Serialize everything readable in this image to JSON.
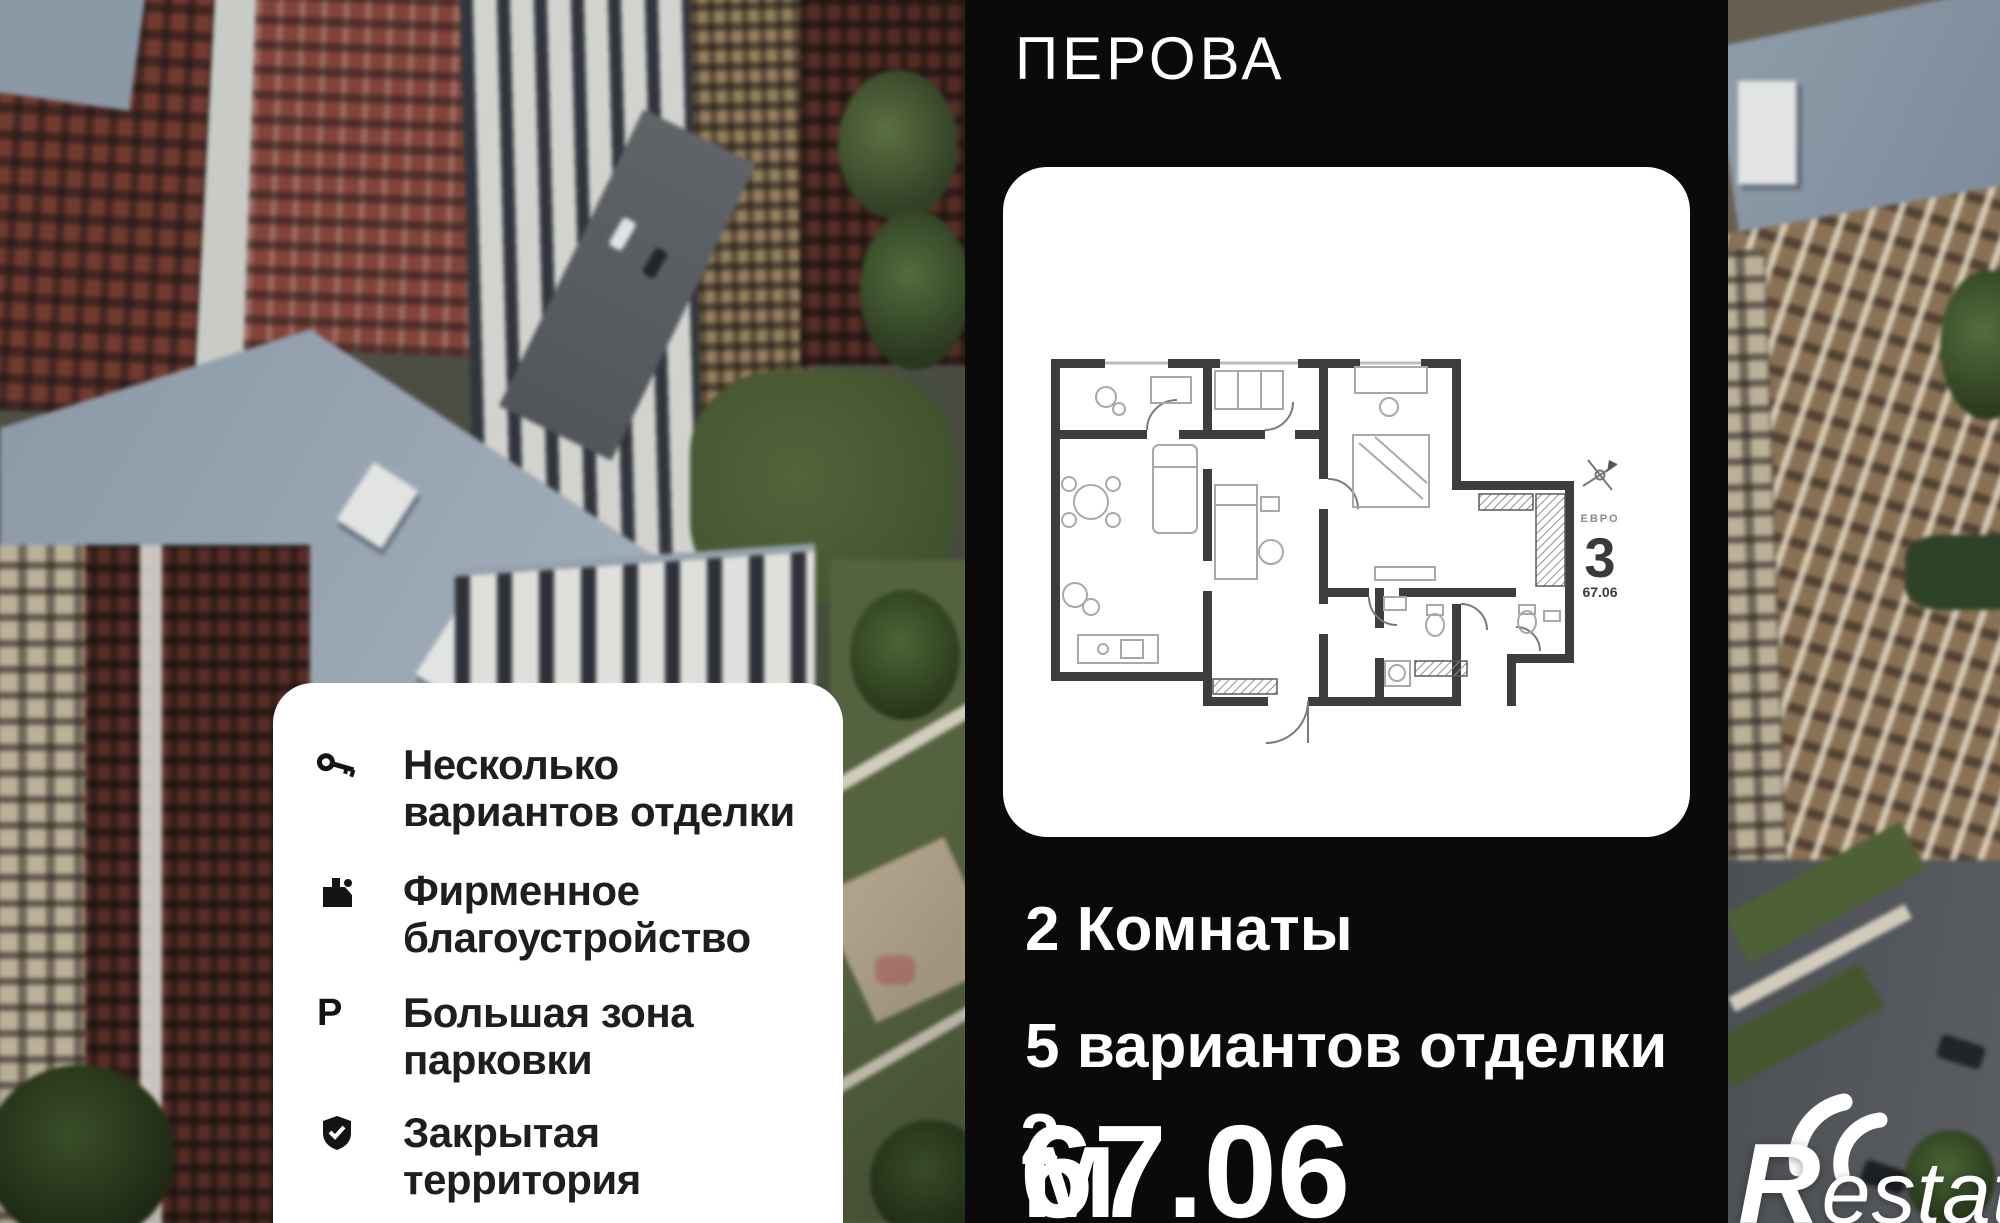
{
  "header": {
    "title_line1_cropped": "ЛЮСТЕН",
    "title_line2": "ПЕРОВА"
  },
  "plan_card": {
    "category_label": "ЕВРО",
    "rooms_number": "3",
    "area_number": "67.06"
  },
  "summary": {
    "rooms_text": "2 Комнаты",
    "finishing_text": "5 вариантов отделки",
    "area_value": "67.06",
    "area_unit": " м",
    "area_sup": "2"
  },
  "features": [
    {
      "icon": "key-icon",
      "line1": "Несколько",
      "line2": "вариантов отделки"
    },
    {
      "icon": "building-icon",
      "line1": "Фирменное",
      "line2": "благоустройство"
    },
    {
      "icon": "parking-icon",
      "glyph": "Р",
      "line1": "Большая зона",
      "line2": "парковки"
    },
    {
      "icon": "shield-check-icon",
      "line1": "Закрытая",
      "line2": "территория"
    }
  ],
  "watermark": {
    "brand": "Restate"
  },
  "colors": {
    "panel_bg": "#0b0a0a",
    "card_bg": "#ffffff",
    "text_dark": "#1e1e20",
    "text_light": "#ffffff",
    "roof_blue": "#8f9dad",
    "brick_red": "#7a3c30"
  }
}
